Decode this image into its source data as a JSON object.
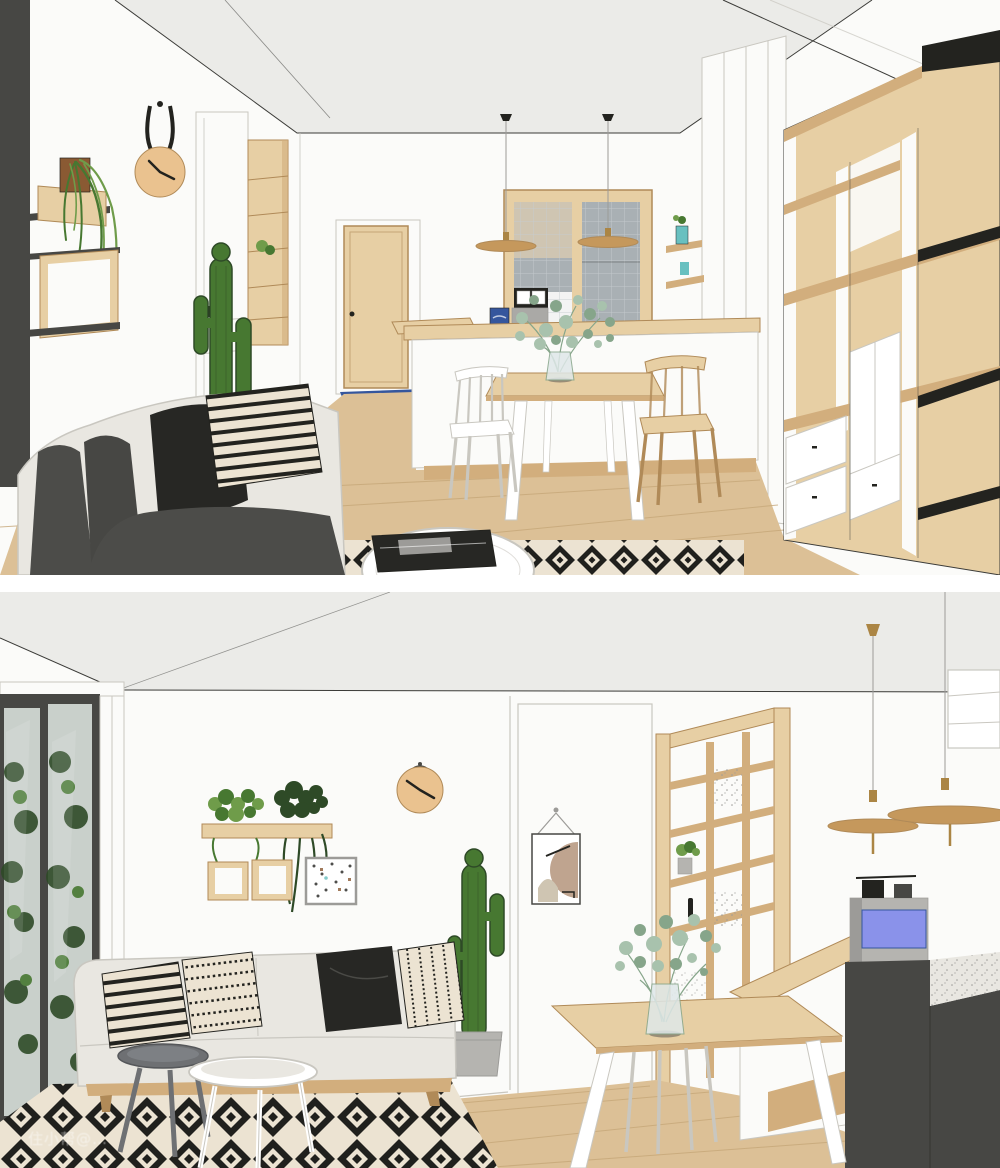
{
  "watermark": {
    "text": "住小帮@…"
  },
  "colors": {
    "white": "#ffffff",
    "wall": "#fbfbf9",
    "ceiling": "#ebebe8",
    "line": "#3b3b38",
    "soft-line": "#c9c7c0",
    "charcoal": "#474744",
    "ink": "#23231f",
    "wood": "#e7cfa4",
    "wood-dark": "#d2ae7d",
    "wood-deep": "#b08a58",
    "floor": "#dcc096",
    "floor-line": "#c5a678",
    "rug-black": "#20201d",
    "rug-cream": "#ece3d2",
    "sofa": "#e9e7e1",
    "sofa-dark": "#4c4c49",
    "cushion-black": "#272724",
    "plant": "#477831",
    "plant-light": "#6f9c4a",
    "plant-dark": "#2e4a27",
    "eucalyptus": "#a8c2ad",
    "eucalyptus-dark": "#86a58a",
    "clock-tan": "#eac28f",
    "mat-blue": "#35569d",
    "machine-blue": "#8a92ea",
    "teal": "#68c0c0",
    "brass": "#ab8544",
    "lamp-wood": "#c5985c",
    "pot-brown": "#8a5a33",
    "concrete": "#b5b4b0",
    "grey": "#9c9b98",
    "steel": "#aaa9a6",
    "glass": "#dfe8e9",
    "glass-door": "#c9d0cb",
    "tile": "#a9b0b4",
    "tile-line": "#c6cccf",
    "backsplash-beige": "#cfc5b2",
    "table-grey": "#6e7073"
  },
  "scenes": {
    "top": {
      "label": "Scandinavian living-dining-kitchen 3D render, view toward kitchen pass-through window and oak shelving wall",
      "objects": [
        "dark charcoal feature wall with wood box shelves and trailing plant",
        "round wooden wall clock on black leather strap",
        "tall white cabinet with oak open-shelf niche",
        "tall cactus",
        "oak interior door with blue doormat",
        "kitchen pass-through window with grey tile backsplash",
        "two wooden disc pendant lamps",
        "coffee machine and blue canister on bar counter",
        "white kitchen island with oak bar top",
        "eucalyptus stems in glass vase",
        "oak-top dining table with white legs",
        "white spindle chair",
        "oak spindle chair",
        "small wall shelves with teal pots",
        "white wardrobe panels",
        "large oak open shelving unit with black shelf edges and white drawers",
        "off-white sofa with charcoal cushions and black and patterned pillows",
        "black-and-white diamond rug",
        "round white coffee table with black tray",
        "light oak plank floor"
      ]
    },
    "bottom": {
      "label": "Same apartment 3D render, view toward sofa wall, glazed partition and kitchen bar",
      "objects": [
        "black-framed sliding glass door with greenery outside",
        "wood wall shelf with pothos and dark hanging plant",
        "two square oak box frames",
        "small framed botanical poster",
        "round wooden wall clock on wire hanger",
        "cactus in concrete pot",
        "hallway with hanging abstract poster",
        "oak-framed glazed partition with textured glass, shelf plant and door handle",
        "two brass-and-wood disc pendant lamps",
        "white island with oak bar top",
        "espresso machine with blue panel",
        "charcoal bar counter with speckled white top",
        "oak-top dining table with white legs and white chairs",
        "eucalyptus stems in glass vase",
        "off-white three-seat sofa on wood rail with four black and white pillows",
        "grey round side table and white round coffee table",
        "black-and-white diamond rug",
        "light oak plank floor",
        "faint app watermark"
      ]
    }
  }
}
